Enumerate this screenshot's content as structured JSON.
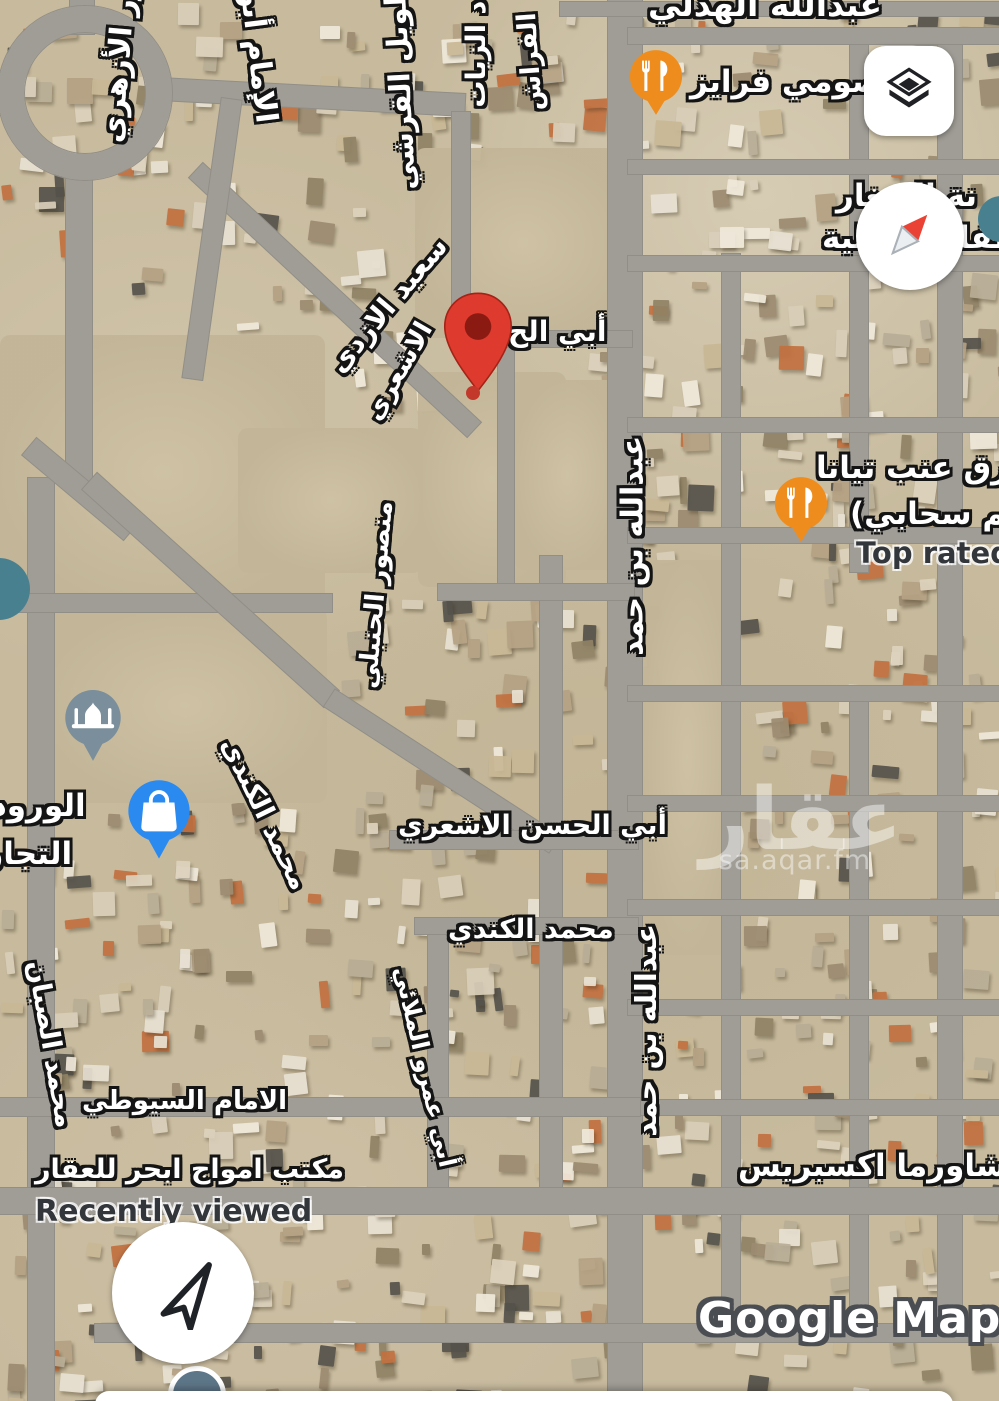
{
  "app": {
    "map_attribution": "Google Maps",
    "watermark_title": "عقار",
    "watermark_subtitle": "sa.aqar.fm"
  },
  "theme": {
    "pin_red": "#de3a2e",
    "pin_red_inner": "#8a1a12",
    "poi_restaurant_orange": "#ee8d1d",
    "poi_shopping_blue": "#2a8af0",
    "poi_mosque_slate": "#7a8e9b",
    "poi_teal": "#48808f",
    "road_gray": "#a09d96",
    "ground_tan": "#c7ba9d"
  },
  "labels": [
    {
      "id": 0,
      "text": "عبدالله الهدلي"
    },
    {
      "id": 1,
      "text": "نور الأزهري"
    },
    {
      "id": 2,
      "text": "الإمام أبو"
    },
    {
      "id": 3,
      "text": "طويل القرشي"
    },
    {
      "id": 4,
      "text": "د الزيات"
    },
    {
      "id": 5,
      "text": "الفراش"
    },
    {
      "id": 6,
      "text": "صومي فرايز"
    },
    {
      "id": 7,
      "text": "نة الصغار"
    },
    {
      "id": 8,
      "text": "طفال الأهلية"
    },
    {
      "id": 9,
      "text": "سعيد الازدي"
    },
    {
      "id": 10,
      "text": "أبي الح"
    },
    {
      "id": 11,
      "text": "الاشعري"
    },
    {
      "id": 12,
      "text": "عبدالله بن حمد"
    },
    {
      "id": 13,
      "text": "رق عنب تيانا"
    },
    {
      "id": 14,
      "text": "عم سحابي)"
    },
    {
      "id": 15,
      "text": "Top rated"
    },
    {
      "id": 16,
      "text": "منصور الحنبلي"
    },
    {
      "id": 17,
      "text": "محمد الكندي"
    },
    {
      "id": 18,
      "text": "الورود الب"
    },
    {
      "id": 19,
      "text": "التجارية ("
    },
    {
      "id": 20,
      "text": "أبي الحسن الاشعري"
    },
    {
      "id": 21,
      "text": "محمد الكندي"
    },
    {
      "id": 22,
      "text": "عبدالله بن حمد"
    },
    {
      "id": 23,
      "text": "محمد الصبان"
    },
    {
      "id": 24,
      "text": "أبي عمرو الملائي"
    },
    {
      "id": 25,
      "text": "الامام السيوطي"
    },
    {
      "id": 26,
      "text": "مكتب امواج ابحر للعقار"
    },
    {
      "id": 27,
      "text": "شاورما اكسبريس"
    },
    {
      "id": 28,
      "text": "Recently viewed"
    },
    {
      "id": 29,
      "text": "Google Maps"
    }
  ]
}
